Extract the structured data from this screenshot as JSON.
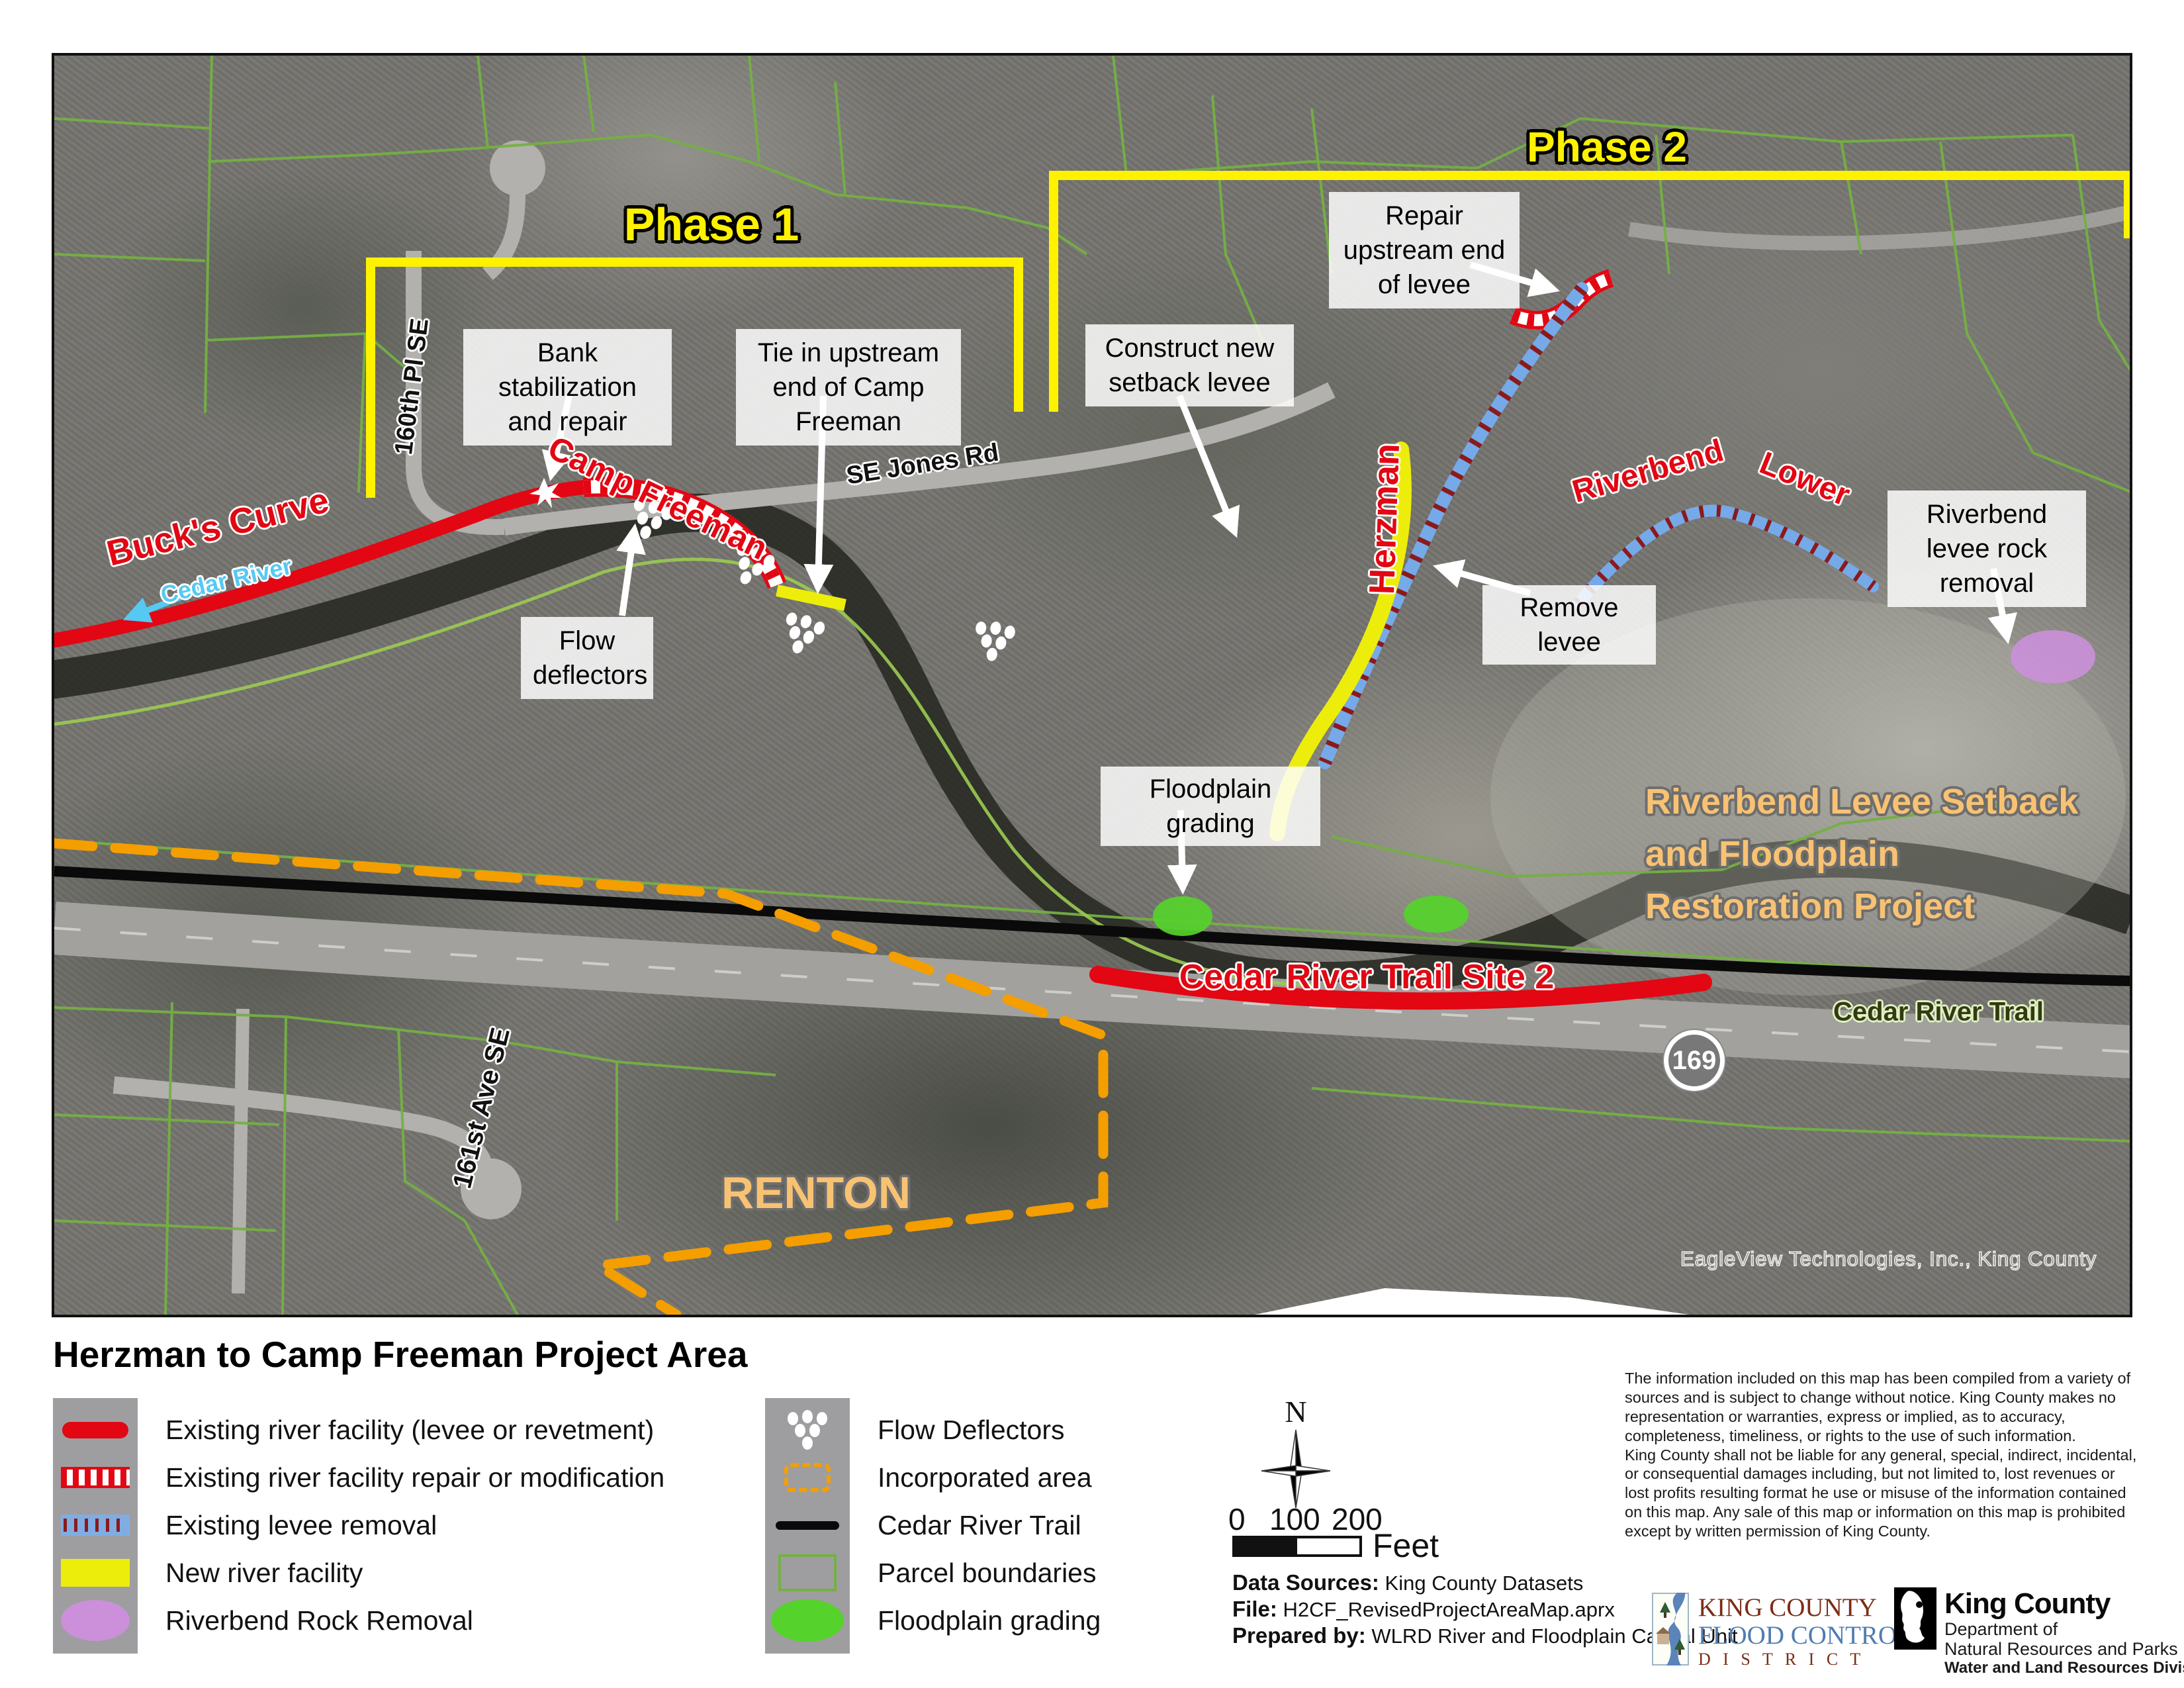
{
  "map": {
    "phase1": "Phase 1",
    "phase2": "Phase 2",
    "callouts": {
      "bank": "Bank stabilization and repair",
      "tie": "Tie in upstream end of Camp Freeman",
      "repair_upstream": "Repair upstream end of levee",
      "construct": "Construct new setback levee",
      "flow": "Flow deflectors",
      "remove": "Remove levee",
      "rock": "Riverbend levee rock removal",
      "floodplain": "Floodplain grading"
    },
    "labels": {
      "bucks_curve": "Buck's Curve",
      "camp_freeman": "Camp Freeman",
      "cedar_river": "Cedar River",
      "pl160": "160th Pl SE",
      "se_jones": "SE Jones Rd",
      "herzman": "Herzman",
      "riverbend_word1": "Riverbend",
      "riverbend_word2": "Lower",
      "project_line1": "Riverbend Levee Setback",
      "project_line2": "and Floodplain",
      "project_line3": "Restoration Project",
      "site2": "Cedar River Trail Site 2",
      "cedar_river_trail": "Cedar River Trail",
      "renton": "RENTON",
      "ave161": "161st Ave SE",
      "route_169": "169",
      "watermark": "EagleView Technologies, Inc., King County"
    }
  },
  "legend": {
    "title": "Herzman to Camp Freeman Project Area",
    "col1": [
      {
        "label": "Existing river facility (levee or revetment)"
      },
      {
        "label": "Existing river facility repair or modification"
      },
      {
        "label": "Existing levee removal"
      },
      {
        "label": "New river facility"
      },
      {
        "label": "Riverbend Rock Removal"
      }
    ],
    "col2": [
      {
        "label": "Flow Deflectors"
      },
      {
        "label": "Incorporated area"
      },
      {
        "label": "Cedar River Trail"
      },
      {
        "label": "Parcel boundaries"
      },
      {
        "label": "Floodplain grading"
      }
    ]
  },
  "scalebar": {
    "north": "N",
    "tick0": "0",
    "tick100": "100",
    "tick200": "200",
    "unit": "Feet"
  },
  "credits": {
    "sources_label": "Data Sources:",
    "sources": "King County Datasets",
    "file_label": "File:",
    "file": "H2CF_RevisedProjectAreaMap.aprx",
    "prepared_label": "Prepared by:",
    "prepared": "WLRD River and Floodplain Capital Unit"
  },
  "disclaimer": {
    "p1": "The information included on this map has been compiled from a variety of sources and is subject to change without notice. King County makes no representation or warranties, express or implied, as to accuracy, completeness, timeliness, or rights to the use of such information.",
    "p2": "King County shall not be liable for any general, special, indirect, incidental, or consequential damages including, but not limited to, lost revenues or lost profits resulting format he use or misuse of the information contained on this map. Any sale of this map or information on this map is prohibited except by written permission of King County."
  },
  "logos": {
    "fcd_line1": "KING COUNTY",
    "fcd_line2": "FLOOD CONTROL",
    "fcd_line3": "D I S T R I C T",
    "kc_name": "King County",
    "kc_dept1": "Department of",
    "kc_dept2": "Natural Resources and Parks",
    "kc_dept3": "Water and Land Resources Division"
  },
  "colors": {
    "existing_facility": "#E30613",
    "new_facility": "#EDED0B",
    "levee_removal_blue": "#76A9E8",
    "hatch_red": "#8B1A1A",
    "rock_removal_purple": "#CB90D9",
    "floodplain_green": "#55D22B",
    "parcel_green": "#74B043",
    "incorporated_orange": "#F59E00",
    "phase_yellow": "#FFF200",
    "project_orange": "#F8C273"
  }
}
